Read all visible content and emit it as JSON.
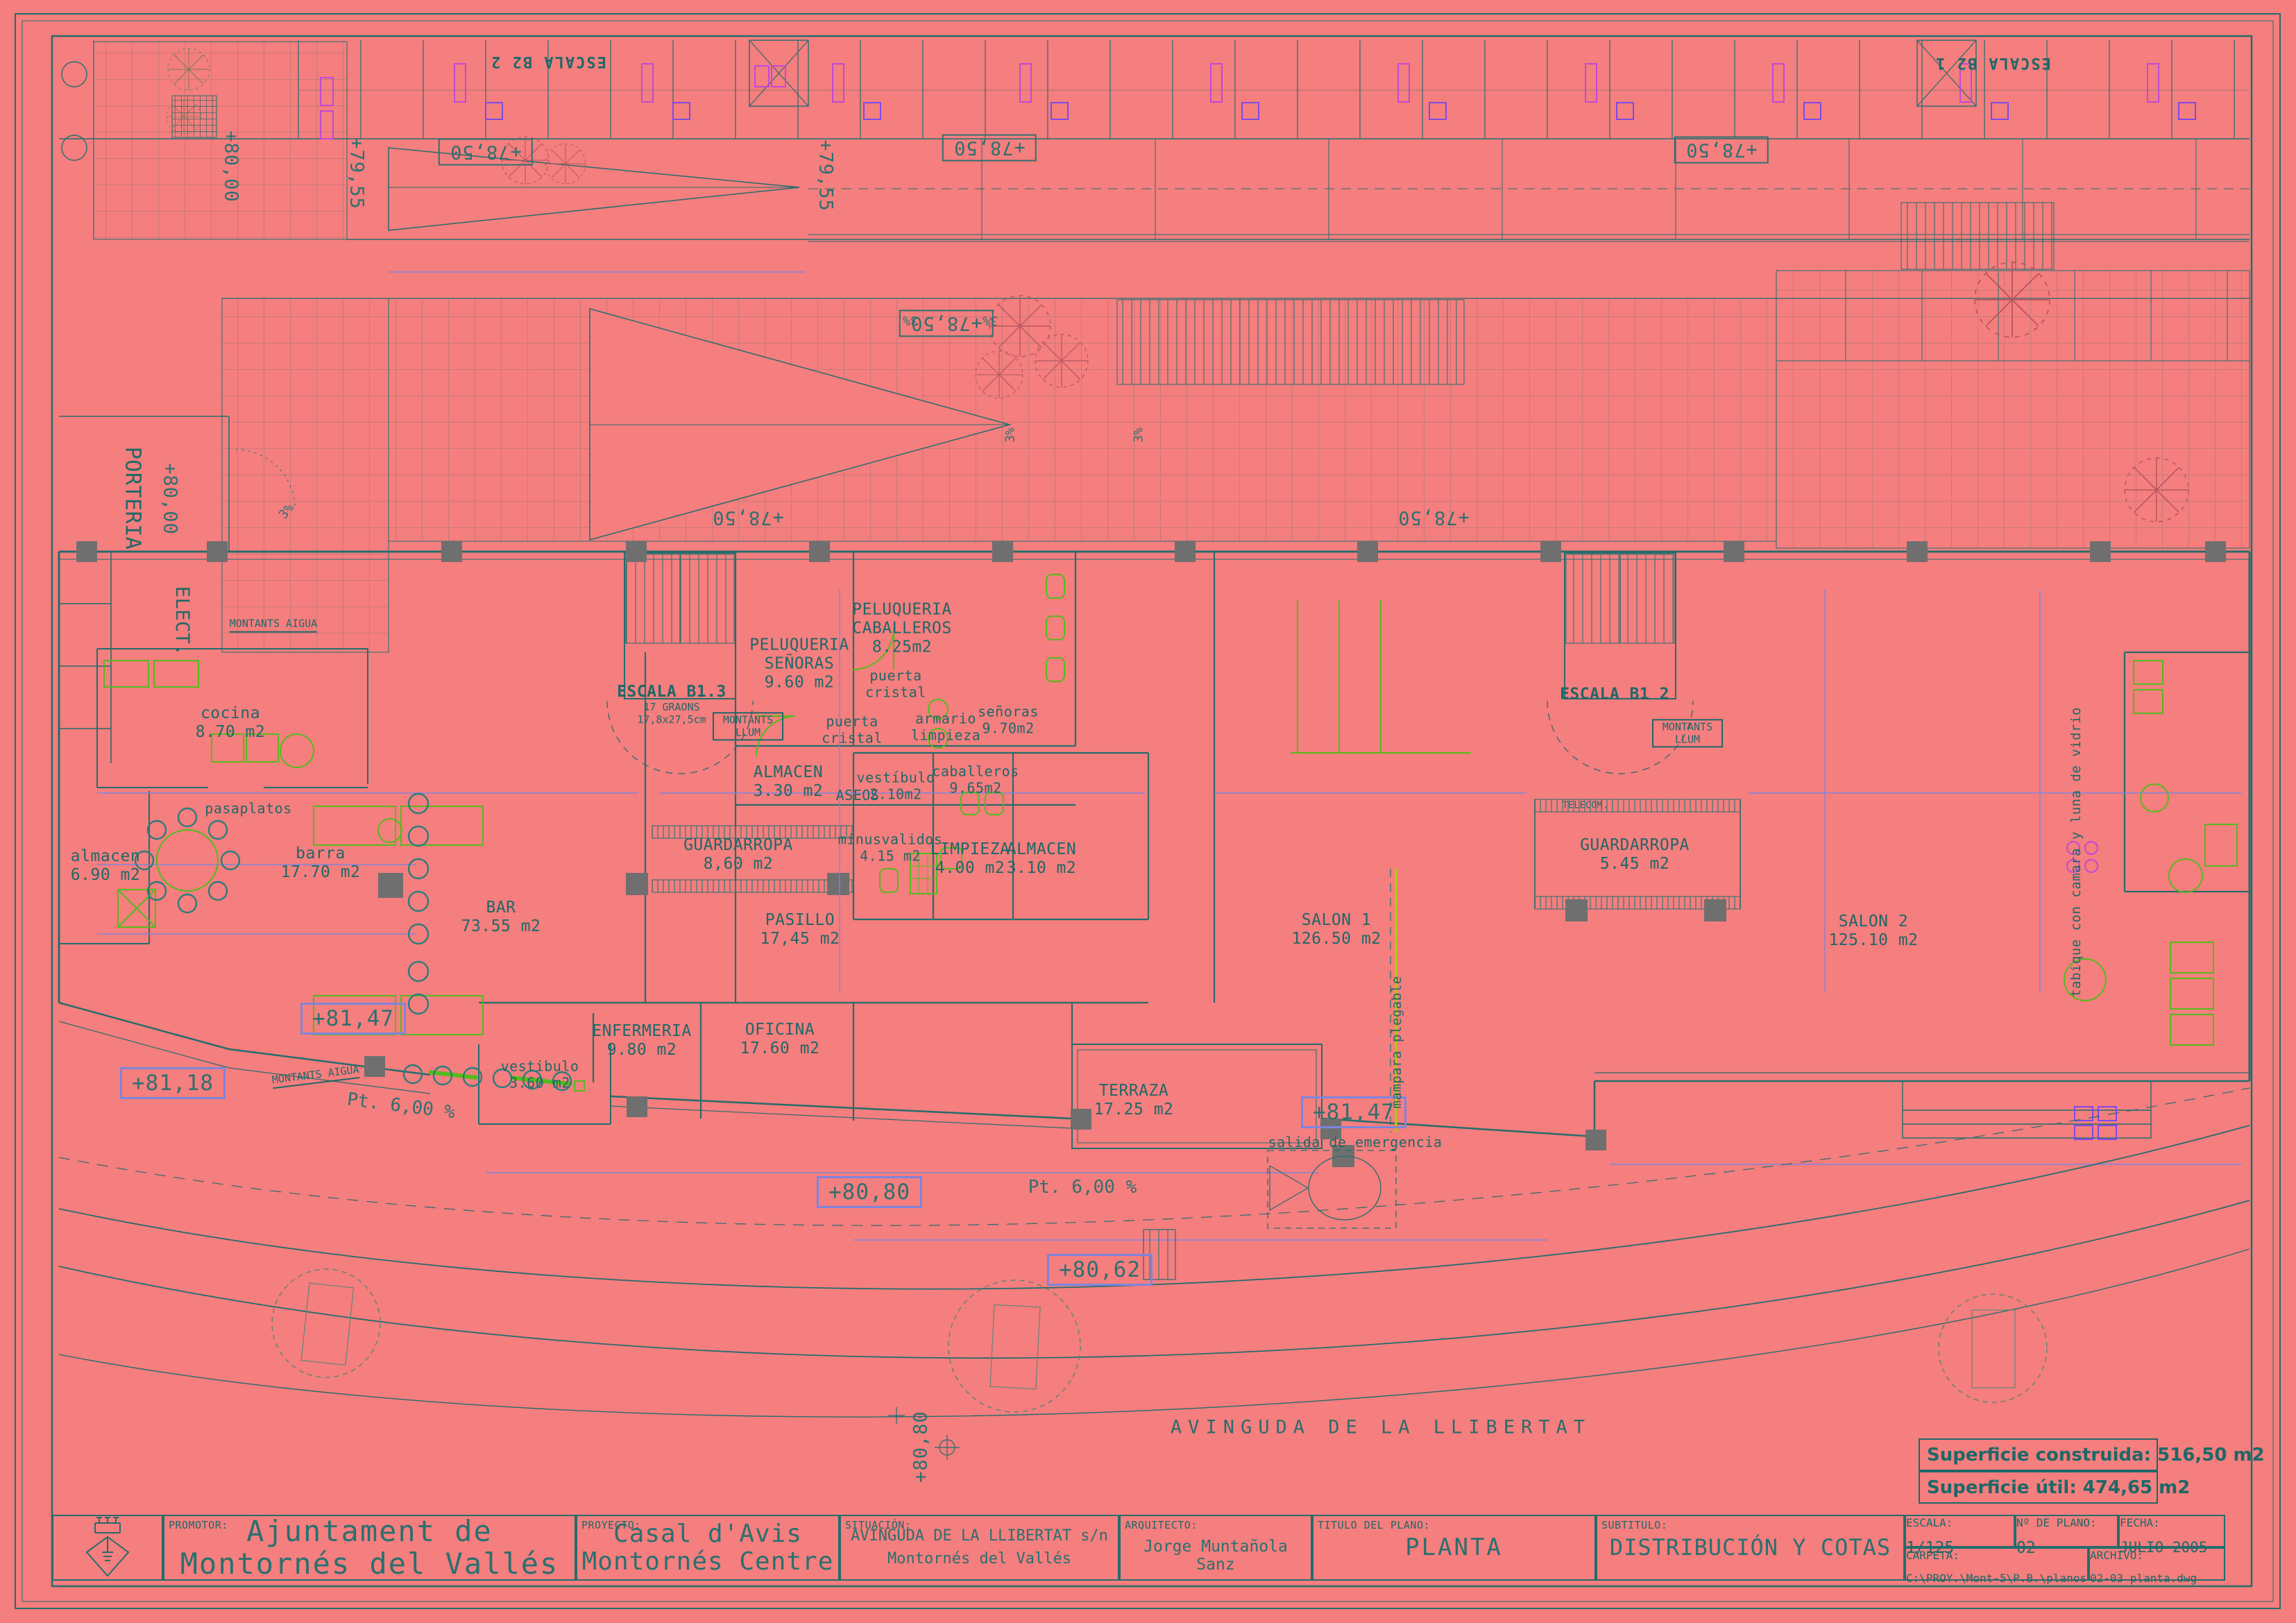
{
  "palette": {
    "background": "#f57e7e",
    "line": "#256d6d",
    "text": "#1f6868",
    "dim_blue": "#7d85dc",
    "green": "#54bb1d",
    "yellow_green": "#b3c414",
    "magenta": "#bf49d8",
    "violet": "#7d4ae8",
    "gray": "#6f6f6f",
    "tree_rose": "#b5575f"
  },
  "street_label": "AVINGUDA DE LA LLIBERTAT",
  "top_band": {
    "stair_left": "ESCALA B2 2",
    "stair_right": "ESCALA B2 1"
  },
  "rooms": [
    {
      "name": "cocina",
      "area": "8.70 m2"
    },
    {
      "name": "almacen",
      "area": "6.90 m2"
    },
    {
      "name": "barra",
      "area": "17.70 m2"
    },
    {
      "name": "BAR",
      "area": "73.55 m2"
    },
    {
      "name": "PELUQUERIA SEÑORAS",
      "area": "9.60 m2"
    },
    {
      "name": "PELUQUERIA CABALLEROS",
      "area": "8.25m2"
    },
    {
      "name": "ALMACEN",
      "area": "3.30 m2"
    },
    {
      "name": "vestíbulo",
      "area": "2.10m2"
    },
    {
      "name": "señoras",
      "area": "9.70m2"
    },
    {
      "name": "caballeros",
      "area": "9.65m2"
    },
    {
      "name": "minusvalidos",
      "area": "4.15 m2"
    },
    {
      "name": "LIMPIEZA",
      "area": "4.00 m2"
    },
    {
      "name": "ALMACEN",
      "area": "3.10 m2"
    },
    {
      "name": "GUARDARROPA",
      "area": "8,60 m2"
    },
    {
      "name": "PASILLO",
      "area": "17,45 m2"
    },
    {
      "name": "ENFERMERIA",
      "area": "9.80 m2"
    },
    {
      "name": "OFICINA",
      "area": "17.60 m2"
    },
    {
      "name": "vestibulo",
      "area": "3.60 m2"
    },
    {
      "name": "TERRAZA",
      "area": "17.25 m2"
    },
    {
      "name": "SALON 1",
      "area": "126.50 m2"
    },
    {
      "name": "SALON 2",
      "area": "125.10 m2"
    },
    {
      "name": "GUARDARROPA",
      "area": "5.45 m2"
    }
  ],
  "stairs": {
    "s1_line1": "ESCALA B1.3",
    "s1_line2": "17 GRAONS",
    "s1_line3": "17,8x27,5cm",
    "s2": "ESCALA B1 2"
  },
  "small_labels": {
    "aseos": "ASEOS",
    "puerta_cristal": "puerta cristal",
    "armario_limpieza": "armario limpieza",
    "montants_llum": "MONTANTS LLUM",
    "montants_aigua": "MONTANTS AIGUA",
    "telecom": "TELECOM.",
    "salida": "salida de emergencia",
    "mampara": "mampara plegable",
    "tabique": "tabique con camara y luna de vidrio",
    "porteria": "PORTERIA",
    "elect": "ELECT.",
    "pasaplatos": "pasaplatos"
  },
  "levels": {
    "l8000": "+80,00",
    "l7955": "+79,55",
    "l7850": "+78,50",
    "l8147": "+81,47",
    "l8118": "+81,18",
    "l8080": "+80,80",
    "l8062": "+80,62"
  },
  "slopes": {
    "pt": "Pt. 6,00 %",
    "p3": "3%"
  },
  "surface": {
    "construida": "Superficie construida: 516,50 m2",
    "util": "Superficie útil: 474,65 m2"
  },
  "title_block": {
    "promotor_label": "PROMOTOR:",
    "promotor": "Ajuntament de Montornés del Vallés",
    "proyecto_label": "PROYECTO:",
    "proyecto": "Casal d'Avis Montornés Centre",
    "situacion_label": "SITUACIÓN:",
    "situacion_1": "AVINGUDA DE LA LLIBERTAT s/n",
    "situacion_2": "Montornés del Vallés",
    "arquitecto_label": "ARQUITECTO:",
    "arquitecto": "Jorge Muntañola Sanz",
    "titulo_label": "TITULO DEL PLANO:",
    "titulo": "PLANTA",
    "subtitulo_label": "SUBTITULO:",
    "subtitulo": "DISTRIBUCIÓN Y COTAS",
    "escala_label": "ESCALA:",
    "escala": "1/125",
    "plano_label": "Nº DE PLANO:",
    "plano": "02",
    "fecha_label": "FECHA:",
    "fecha": "JULIO 2005",
    "carpeta_label": "CARPETA:",
    "carpeta": "C:\\PROY.\\Mont-5\\P.B.\\planos",
    "archivo_label": "ARCHIVO:",
    "archivo": "02-03 planta.dwg"
  }
}
